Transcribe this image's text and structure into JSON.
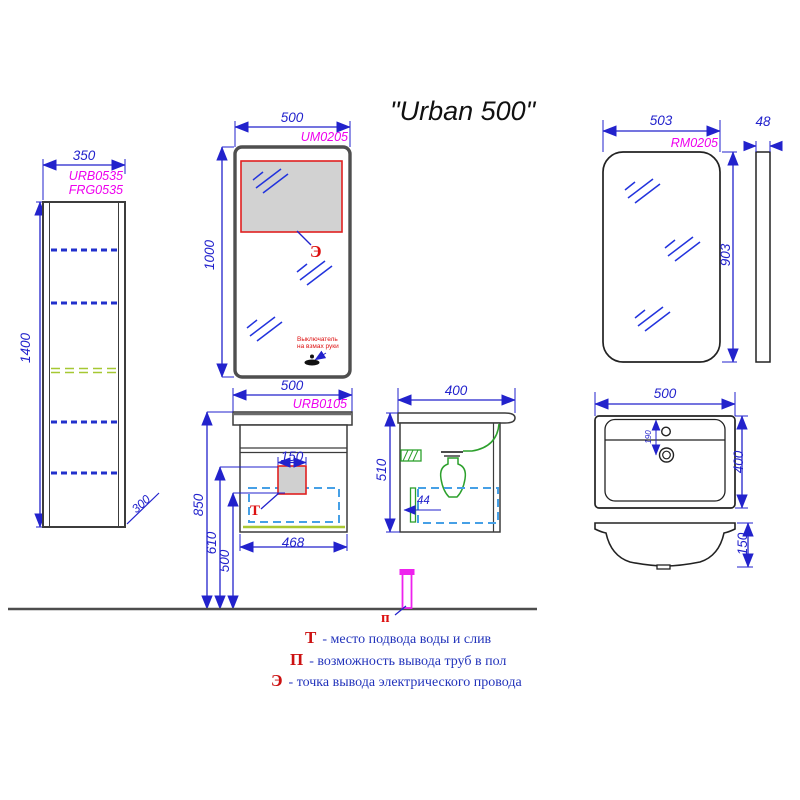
{
  "title": "\"Urban 500\"",
  "tall_cabinet": {
    "code_line1": "URB0535",
    "code_line2": "FRG0535",
    "width": "350",
    "height": "1400",
    "depth": "300"
  },
  "mirror_um": {
    "code": "UM0205",
    "width": "500",
    "height": "1000",
    "electric_marker": "Э",
    "switch_note_line1": "Выключатель",
    "switch_note_line2": "на взмах руки"
  },
  "mirror_rm": {
    "code": "RM0205",
    "width": "503",
    "height": "903",
    "thickness": "48"
  },
  "vanity": {
    "code": "URB0105",
    "width": "500",
    "inner_width": "468",
    "zone_width": "150",
    "height_total": "850",
    "height_zone_top": "610",
    "height_zone_bottom": "500",
    "water_marker": "Т"
  },
  "vanity_side": {
    "depth": "400",
    "height": "510",
    "pipe_offset": "44"
  },
  "sink": {
    "width": "500",
    "depth": "400",
    "faucet_offset": "190",
    "bowl_height": "150"
  },
  "floor_pipe": {
    "marker": "п"
  },
  "legend": [
    {
      "symbol": "Т",
      "text": "- место подвода воды и слив"
    },
    {
      "symbol": "П",
      "text": "- возможность вывода труб в пол"
    },
    {
      "symbol": "Э",
      "text": "- точка вывода электрического провода"
    }
  ],
  "colors": {
    "dimension_blue": "#2222cc",
    "product_code_magenta": "#ee00ee",
    "marker_red": "#dd1111",
    "plumbing_green": "#2ca02c",
    "shelf_green": "#a6c832",
    "drawer_dashed_blue": "#46a0e6",
    "outline_gray": "#3c3c3c",
    "zone_fill_gray": "#d2d2d2"
  }
}
